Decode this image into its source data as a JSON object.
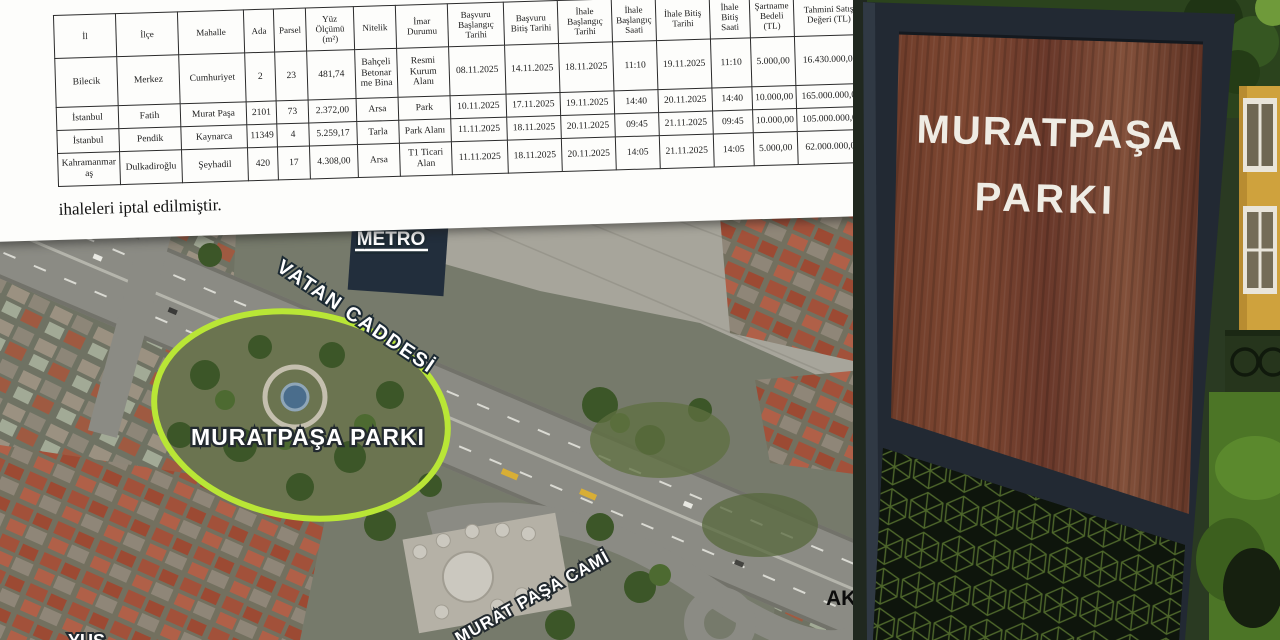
{
  "document": {
    "table": {
      "headers": [
        "İl",
        "İlçe",
        "Mahalle",
        "Ada",
        "Parsel",
        "Yüz Ölçümü (m²)",
        "Nitelik",
        "İmar Durumu",
        "Başvuru Başlangıç Tarihi",
        "Başvuru Bitiş Tarihi",
        "İhale Başlangıç Tarihi",
        "İhale Başlangıç Saati",
        "İhale Bitiş Tarihi",
        "İhale Bitiş Saati",
        "Şartname Bedeli (TL)",
        "Tahmini Satış Değeri (TL)"
      ],
      "rows": [
        [
          "Bilecik",
          "Merkez",
          "Cumhuriyet",
          "2",
          "23",
          "481,74",
          "Bahçeli Betonarme Bina",
          "Resmi Kurum Alanı",
          "08.11.2025",
          "14.11.2025",
          "18.11.2025",
          "11:10",
          "19.11.2025",
          "11:10",
          "5.000,00",
          "16.430.000,00"
        ],
        [
          "İstanbul",
          "Fatih",
          "Murat Paşa",
          "2101",
          "73",
          "2.372,00",
          "Arsa",
          "Park",
          "10.11.2025",
          "17.11.2025",
          "19.11.2025",
          "14:40",
          "20.11.2025",
          "14:40",
          "10.000,00",
          "165.000.000,00"
        ],
        [
          "İstanbul",
          "Pendik",
          "Kaynarca",
          "11349",
          "4",
          "5.259,17",
          "Tarla",
          "Park Alanı",
          "11.11.2025",
          "18.11.2025",
          "20.11.2025",
          "09:45",
          "21.11.2025",
          "09:45",
          "10.000,00",
          "105.000.000,00"
        ],
        [
          "Kahramanmaraş",
          "Dulkadiroğlu",
          "Şeyhadil",
          "420",
          "17",
          "4.308,00",
          "Arsa",
          "T1 Ticari Alan",
          "11.11.2025",
          "18.11.2025",
          "20.11.2025",
          "14:05",
          "21.11.2025",
          "14:05",
          "5.000,00",
          "62.000.000,00"
        ]
      ]
    },
    "note": "ihaleleri iptal edilmiştir."
  },
  "map": {
    "labels": {
      "metro": "METRO",
      "street": "VATAN CADDESİ",
      "park": "MURATPAŞA PARKI",
      "mosque": "MURAT PAŞA CAMİ",
      "district_right": "AKS",
      "district_bottom": "YUS"
    },
    "highlight_color": "#b9e636"
  },
  "photo": {
    "sign": {
      "line1": "MURATPAŞA",
      "line2": "PARKI"
    },
    "colors": {
      "frame": "#222933",
      "text": "#efece4"
    }
  }
}
